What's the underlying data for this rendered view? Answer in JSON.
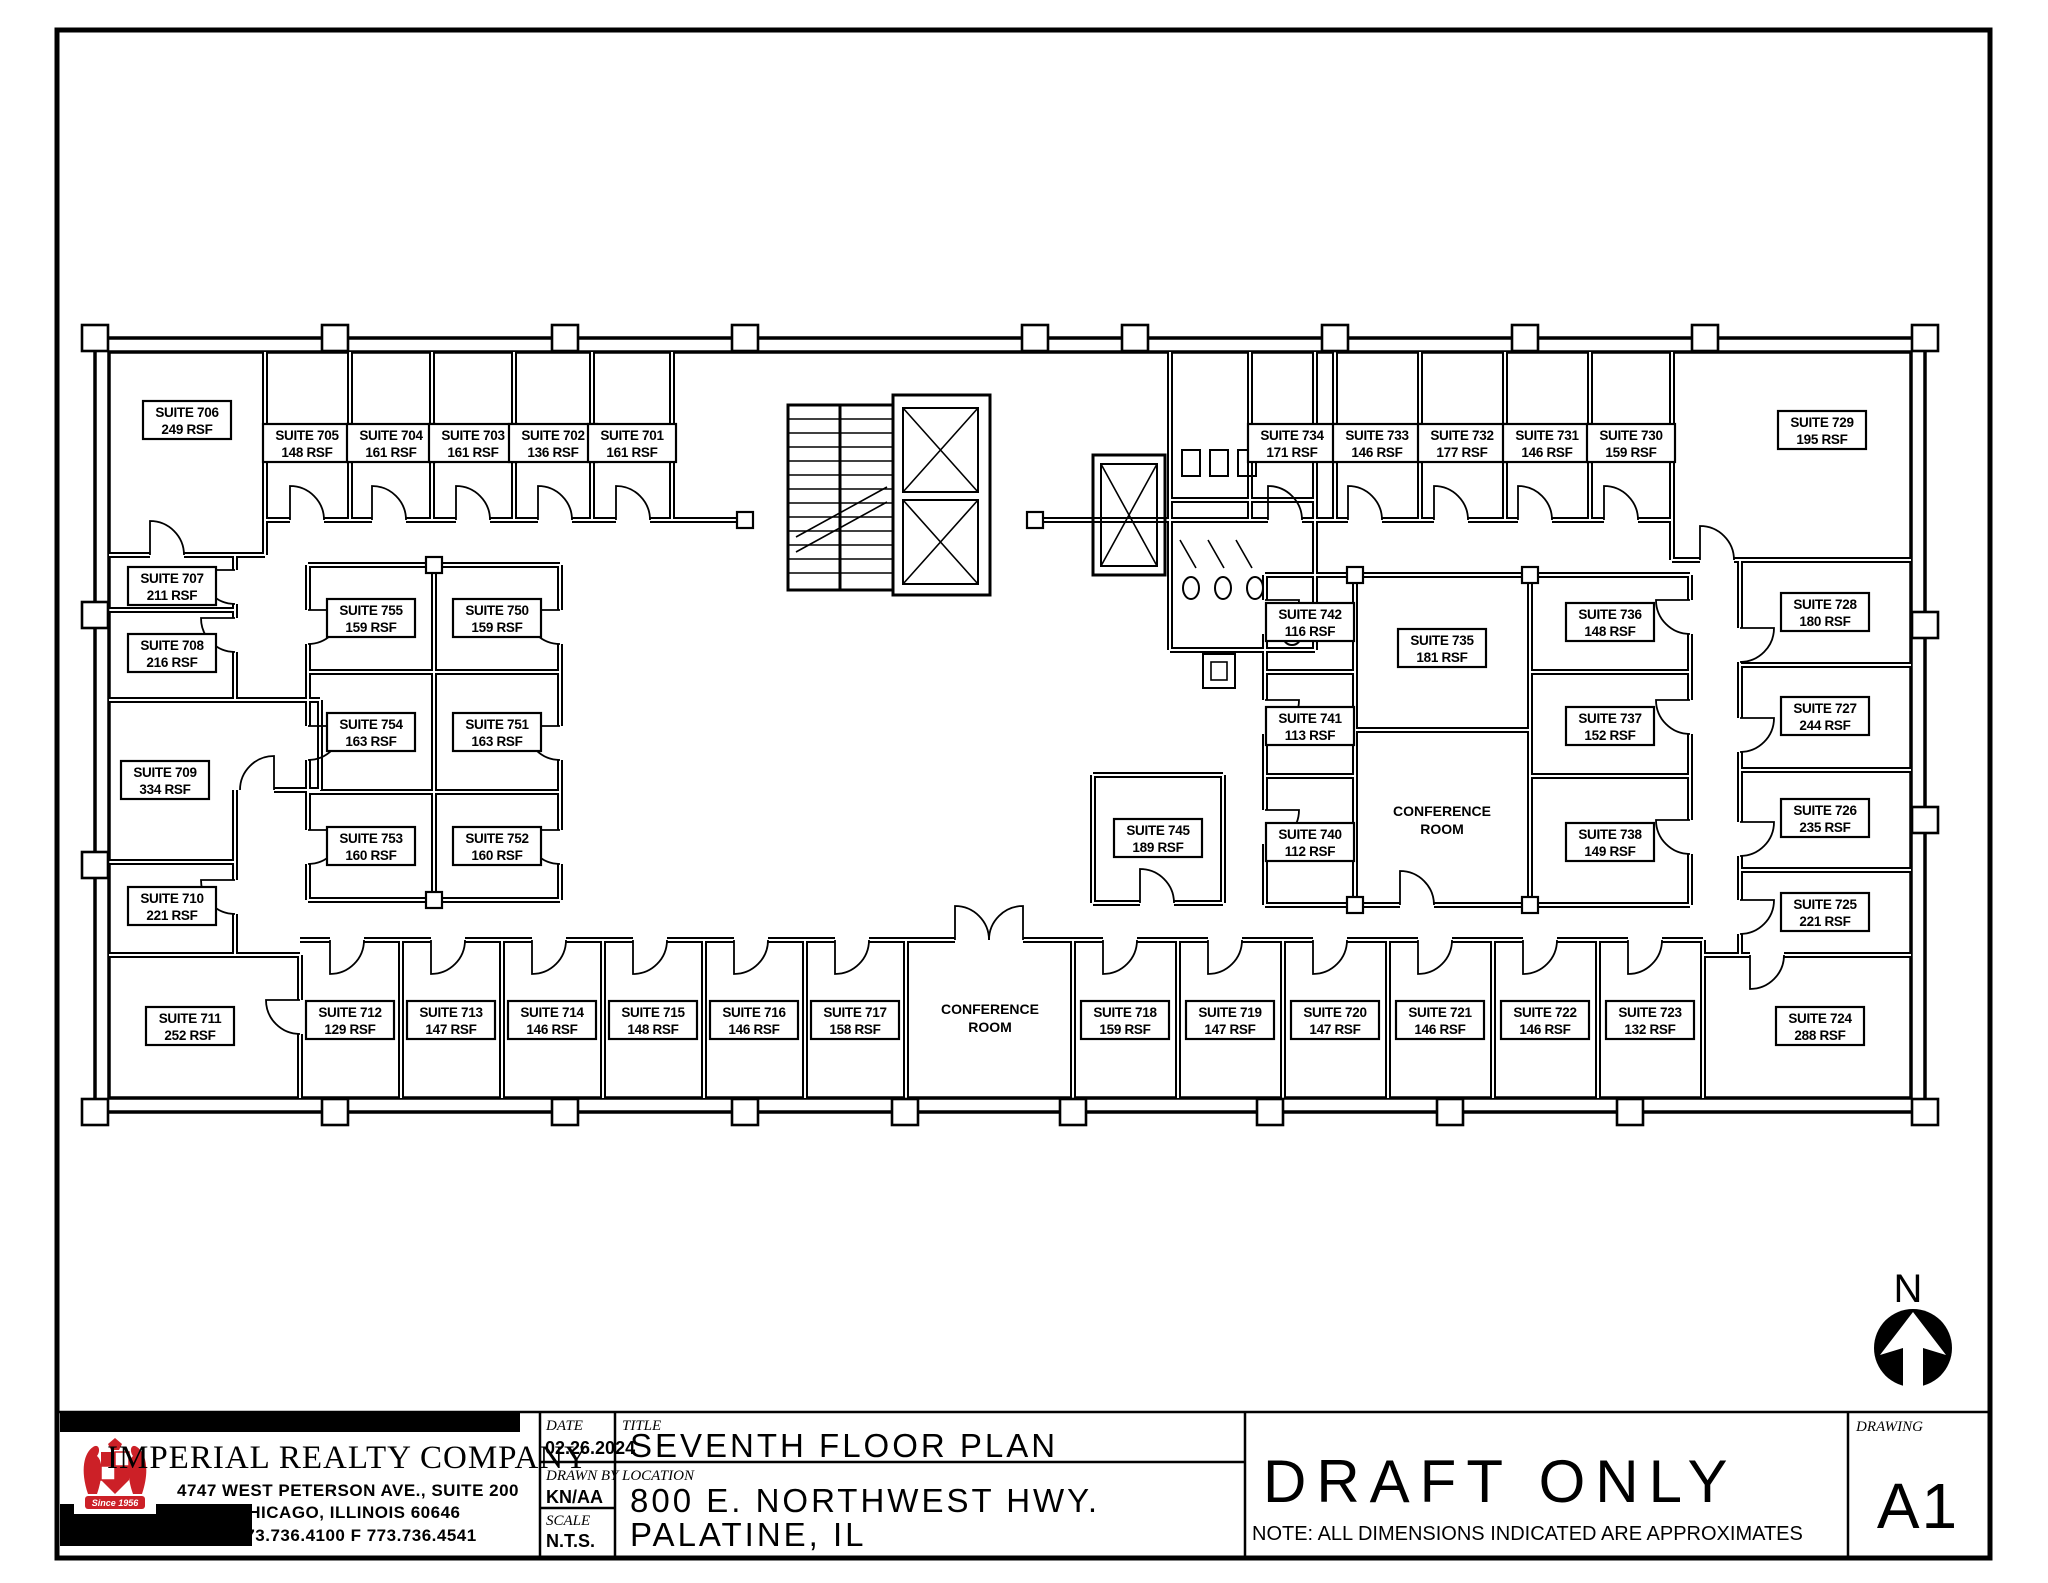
{
  "sheet": {
    "stamp": "DRAFT ONLY",
    "note": "NOTE: ALL DIMENSIONS INDICATED ARE APPROXIMATES",
    "date_label": "DATE",
    "date": "02.26.2024",
    "drawn_by_label": "DRAWN BY",
    "drawn_by": "KN/AA",
    "scale_label": "SCALE",
    "scale": "N.T.S.",
    "title_label": "TITLE",
    "title": "SEVENTH FLOOR PLAN",
    "location_label": "LOCATION",
    "location_line1": "800 E. NORTHWEST HWY.",
    "location_line2": "PALATINE, IL",
    "drawing_label": "DRAWING",
    "drawing_number": "A1",
    "north_label": "N"
  },
  "company": {
    "name": "IMPERIAL REALTY COMPANY",
    "address_line1": "4747 WEST PETERSON AVE., SUITE 200",
    "address_line2": "CHICAGO, ILLINOIS 60646",
    "phone_line": "T 773.736.4100      F 773.736.4541",
    "logo_banner": "Since 1956",
    "logo_color": "#cc2027"
  },
  "floor_plan": {
    "suites": [
      {
        "suite": "SUITE 706",
        "rsf": "249 RSF",
        "x": 187,
        "y": 420
      },
      {
        "suite": "SUITE 705",
        "rsf": "148 RSF",
        "x": 307,
        "y": 443
      },
      {
        "suite": "SUITE 704",
        "rsf": "161 RSF",
        "x": 391,
        "y": 443
      },
      {
        "suite": "SUITE 703",
        "rsf": "161 RSF",
        "x": 473,
        "y": 443
      },
      {
        "suite": "SUITE 702",
        "rsf": "136 RSF",
        "x": 553,
        "y": 443
      },
      {
        "suite": "SUITE 701",
        "rsf": "161 RSF",
        "x": 632,
        "y": 443
      },
      {
        "suite": "SUITE 734",
        "rsf": "171 RSF",
        "x": 1292,
        "y": 443
      },
      {
        "suite": "SUITE 733",
        "rsf": "146 RSF",
        "x": 1377,
        "y": 443
      },
      {
        "suite": "SUITE 732",
        "rsf": "177 RSF",
        "x": 1462,
        "y": 443
      },
      {
        "suite": "SUITE 731",
        "rsf": "146 RSF",
        "x": 1547,
        "y": 443
      },
      {
        "suite": "SUITE 730",
        "rsf": "159 RSF",
        "x": 1631,
        "y": 443
      },
      {
        "suite": "SUITE 729",
        "rsf": "195 RSF",
        "x": 1822,
        "y": 430
      },
      {
        "suite": "SUITE 707",
        "rsf": "211 RSF",
        "x": 172,
        "y": 586
      },
      {
        "suite": "SUITE 708",
        "rsf": "216 RSF",
        "x": 172,
        "y": 653
      },
      {
        "suite": "SUITE 709",
        "rsf": "334 RSF",
        "x": 165,
        "y": 780
      },
      {
        "suite": "SUITE 710",
        "rsf": "221 RSF",
        "x": 172,
        "y": 906
      },
      {
        "suite": "SUITE 711",
        "rsf": "252 RSF",
        "x": 190,
        "y": 1026
      },
      {
        "suite": "SUITE 728",
        "rsf": "180 RSF",
        "x": 1825,
        "y": 612
      },
      {
        "suite": "SUITE 727",
        "rsf": "244 RSF",
        "x": 1825,
        "y": 716
      },
      {
        "suite": "SUITE 726",
        "rsf": "235 RSF",
        "x": 1825,
        "y": 818
      },
      {
        "suite": "SUITE 725",
        "rsf": "221 RSF",
        "x": 1825,
        "y": 912
      },
      {
        "suite": "SUITE 724",
        "rsf": "288 RSF",
        "x": 1820,
        "y": 1026
      },
      {
        "suite": "SUITE 755",
        "rsf": "159 RSF",
        "x": 371,
        "y": 618
      },
      {
        "suite": "SUITE 750",
        "rsf": "159 RSF",
        "x": 497,
        "y": 618
      },
      {
        "suite": "SUITE 754",
        "rsf": "163 RSF",
        "x": 371,
        "y": 732
      },
      {
        "suite": "SUITE 751",
        "rsf": "163 RSF",
        "x": 497,
        "y": 732
      },
      {
        "suite": "SUITE 753",
        "rsf": "160 RSF",
        "x": 371,
        "y": 846
      },
      {
        "suite": "SUITE 752",
        "rsf": "160 RSF",
        "x": 497,
        "y": 846
      },
      {
        "suite": "SUITE 742",
        "rsf": "116 RSF",
        "x": 1310,
        "y": 622
      },
      {
        "suite": "SUITE 741",
        "rsf": "113 RSF",
        "x": 1310,
        "y": 726
      },
      {
        "suite": "SUITE 740",
        "rsf": "112 RSF",
        "x": 1310,
        "y": 842
      },
      {
        "suite": "SUITE 735",
        "rsf": "181 RSF",
        "x": 1442,
        "y": 648
      },
      {
        "suite": "SUITE 736",
        "rsf": "148 RSF",
        "x": 1610,
        "y": 622
      },
      {
        "suite": "SUITE 737",
        "rsf": "152 RSF",
        "x": 1610,
        "y": 726
      },
      {
        "suite": "SUITE 738",
        "rsf": "149 RSF",
        "x": 1610,
        "y": 842
      },
      {
        "suite": "SUITE 745",
        "rsf": "189 RSF",
        "x": 1158,
        "y": 838
      },
      {
        "suite": "SUITE 712",
        "rsf": "129 RSF",
        "x": 350,
        "y": 1020
      },
      {
        "suite": "SUITE 713",
        "rsf": "147 RSF",
        "x": 451,
        "y": 1020
      },
      {
        "suite": "SUITE 714",
        "rsf": "146 RSF",
        "x": 552,
        "y": 1020
      },
      {
        "suite": "SUITE 715",
        "rsf": "148 RSF",
        "x": 653,
        "y": 1020
      },
      {
        "suite": "SUITE 716",
        "rsf": "146 RSF",
        "x": 754,
        "y": 1020
      },
      {
        "suite": "SUITE 717",
        "rsf": "158 RSF",
        "x": 855,
        "y": 1020
      },
      {
        "suite": "SUITE 718",
        "rsf": "159 RSF",
        "x": 1125,
        "y": 1020
      },
      {
        "suite": "SUITE 719",
        "rsf": "147 RSF",
        "x": 1230,
        "y": 1020
      },
      {
        "suite": "SUITE 720",
        "rsf": "147 RSF",
        "x": 1335,
        "y": 1020
      },
      {
        "suite": "SUITE 721",
        "rsf": "146 RSF",
        "x": 1440,
        "y": 1020
      },
      {
        "suite": "SUITE 722",
        "rsf": "146 RSF",
        "x": 1545,
        "y": 1020
      },
      {
        "suite": "SUITE 723",
        "rsf": "132 RSF",
        "x": 1650,
        "y": 1020
      }
    ],
    "rooms": [
      {
        "line1": "CONFERENCE",
        "line2": "ROOM",
        "x": 990,
        "y": 1014
      },
      {
        "line1": "CONFERENCE",
        "line2": "ROOM",
        "x": 1442,
        "y": 816
      }
    ]
  }
}
